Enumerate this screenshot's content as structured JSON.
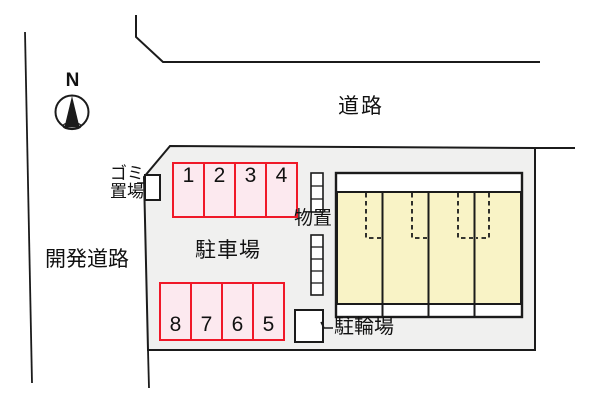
{
  "labels": {
    "road_top": "道路",
    "road_left": "開発道路",
    "parking_lot": "駐車場",
    "garbage_area": "ゴミ\n置場",
    "storage": "物置",
    "bicycle_parking": "駐輪場",
    "compass_north": "N"
  },
  "parking": {
    "top_row": [
      "1",
      "2",
      "3",
      "4"
    ],
    "bottom_row": [
      "8",
      "7",
      "6",
      "5"
    ]
  },
  "building": {
    "unit_count": 4
  },
  "colors": {
    "plot_fill": "#f0f0ef",
    "stall_fill": "#fce9ef",
    "stall_border": "#f01828",
    "building_fill": "#f9f3c6",
    "line": "#1b1b1b"
  }
}
